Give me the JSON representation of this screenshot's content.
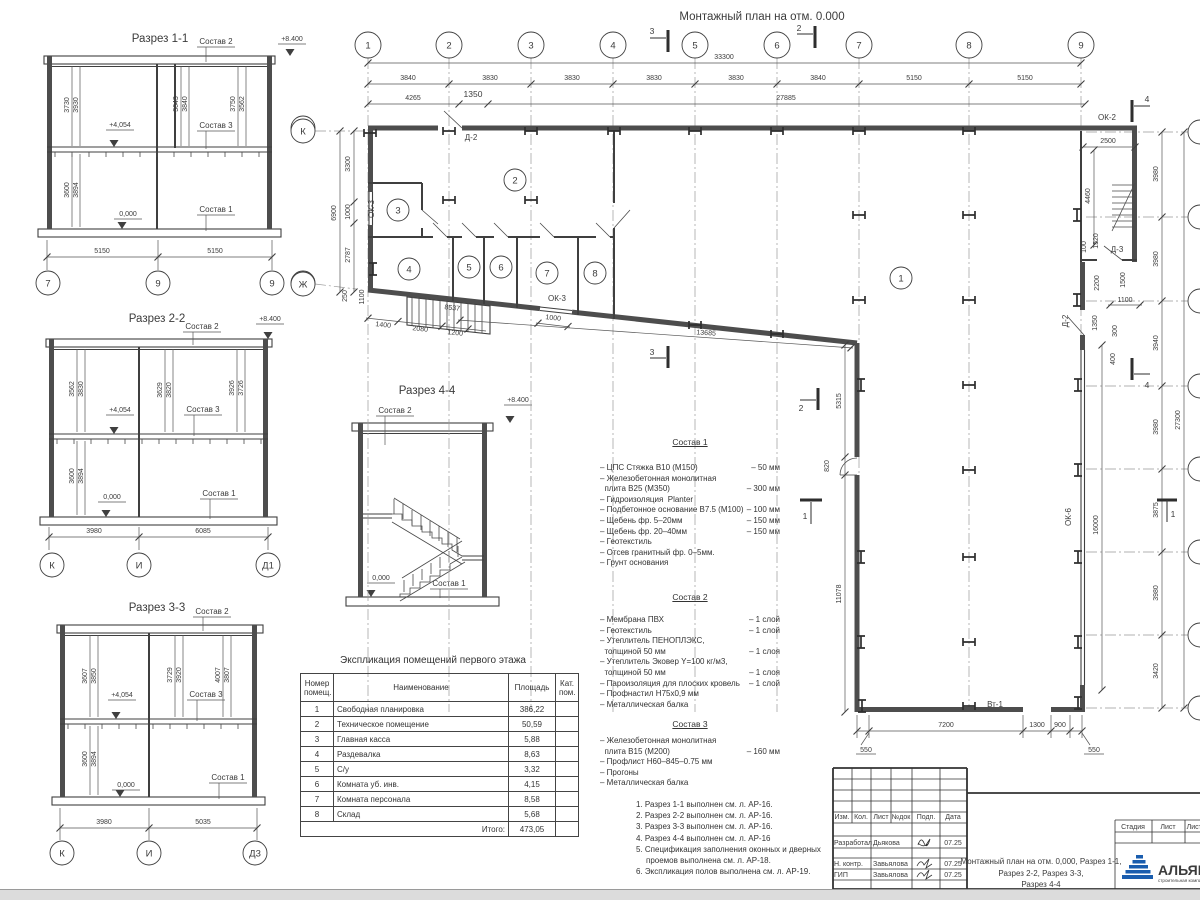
{
  "plan": {
    "title": "Монтажный план на отм. 0.000",
    "grid_cols": [
      "1",
      "2",
      "3",
      "4",
      "5",
      "6",
      "7",
      "8",
      "9"
    ],
    "grid_rows": [
      "К",
      "Ж"
    ],
    "dim_rows": {
      "total": "33300",
      "cols": [
        "3840",
        "3830",
        "3830",
        "3830",
        "3830",
        "3840",
        "5150",
        "5150"
      ],
      "row2": [
        "4265",
        "1350",
        "27885"
      ]
    },
    "dims_left": [
      "3300",
      "1000",
      "2787",
      "6900",
      "250",
      "1100"
    ],
    "dims_right": [
      "3980",
      "3980",
      "3940",
      "3980",
      "3875",
      "3980",
      "3420"
    ],
    "right_total": "27300",
    "dims_bottom": [
      "550",
      "7200",
      "1300",
      "900",
      "550"
    ],
    "dims_wall_right": [
      "5315",
      "820",
      "11078",
      "16000"
    ],
    "dims_tower": [
      "2500",
      "4460",
      "100",
      "1520",
      "2200",
      "1500",
      "1100",
      "1350",
      "300",
      "400"
    ],
    "dims_slope": [
      "1400",
      "2080",
      "1200",
      "8537",
      "1000",
      "13685"
    ],
    "rooms": [
      "1",
      "2",
      "3",
      "4",
      "5",
      "6",
      "7",
      "8"
    ],
    "labels": {
      "ok2": "ОК-2",
      "ok3_left": "ОК-3",
      "ok3_bottom": "ОК-3",
      "ok6": "ОК-6",
      "d2_top": "Д-2",
      "d2_right": "Д-2",
      "d3": "Д-3",
      "vt1": "Вт-1"
    },
    "marks": {
      "m1": "1",
      "m2": "2",
      "m3": "3",
      "m4": "4"
    }
  },
  "sections": {
    "s11": {
      "title": "Разрез 1-1",
      "elev_top": "+8.400",
      "elev_mid": "+4,054",
      "elev_zero": "0,000",
      "lbl1": "Состав 1",
      "lbl2": "Состав 2",
      "lbl3": "Состав 3",
      "dims_upper": [
        "3730",
        "3930",
        "3643",
        "3840",
        "3750",
        "3562"
      ],
      "dims_lower": [
        "3600",
        "3894"
      ],
      "dims_bottom": [
        "5150",
        "5150"
      ],
      "grid": [
        "7",
        "9",
        "9"
      ],
      "grid_right": [
        "К",
        "Ж"
      ]
    },
    "s22": {
      "title": "Разрез 2-2",
      "elev_top": "+8.400",
      "elev_mid": "+4,054",
      "elev_zero": "0,000",
      "lbl1": "Состав 1",
      "lbl2": "Состав 2",
      "lbl3": "Состав 3",
      "dims_upper": [
        "3562",
        "3830",
        "3629",
        "3820",
        "3926",
        "3726"
      ],
      "dims_lower": [
        "3600",
        "3894"
      ],
      "dims_bottom": [
        "3980",
        "6085"
      ],
      "grid": [
        "К",
        "И",
        "Д1"
      ]
    },
    "s33": {
      "title": "Разрез 3-3",
      "elev_mid": "+4,054",
      "elev_zero": "0,000",
      "lbl1": "Состав 1",
      "lbl2": "Состав 2",
      "lbl3": "Состав 3",
      "dims_upper": [
        "3607",
        "3850",
        "3729",
        "3920",
        "4007",
        "3807"
      ],
      "dims_lower": [
        "3600",
        "3894"
      ],
      "dims_bottom": [
        "3980",
        "5035"
      ],
      "grid": [
        "К",
        "И",
        "Д3"
      ]
    },
    "s44": {
      "title": "Разрез 4-4",
      "elev_top": "+8.400",
      "elev_zero": "0,000",
      "lbl1": "Состав 1",
      "lbl2": "Состав 2"
    }
  },
  "table": {
    "title": "Экспликация помещений первого этажа",
    "headers": [
      "Номер помещ.",
      "Наименование",
      "Площадь",
      "Кат. пом."
    ],
    "rows": [
      [
        "1",
        "Свободная планировка",
        "386,22"
      ],
      [
        "2",
        "Техническое помещение",
        "50,59"
      ],
      [
        "3",
        "Главная касса",
        "5,88"
      ],
      [
        "4",
        "Раздевалка",
        "8,63"
      ],
      [
        "5",
        "С/у",
        "3,32"
      ],
      [
        "6",
        "Комната уб. инв.",
        "4,15"
      ],
      [
        "7",
        "Комната персонала",
        "8,58"
      ],
      [
        "8",
        "Склад",
        "5,68"
      ]
    ],
    "total_label": "Итого:",
    "total_value": "473,05"
  },
  "sostav1": {
    "title": "Состав 1",
    "lines": [
      {
        "t": "– ЦПС Стяжка В10 (М150)",
        "v": "– 50 мм"
      },
      {
        "t": "– Железобетонная монолитная",
        "v": ""
      },
      {
        "t": "  плита В25 (М350)",
        "v": "– 300 мм"
      },
      {
        "t": "– Гидроизоляция  Planter",
        "v": ""
      },
      {
        "t": "– Подбетонное основание В7.5 (М100)",
        "v": "– 100 мм"
      },
      {
        "t": "– Щебень фр. 5–20мм",
        "v": "– 150 мм"
      },
      {
        "t": "– Щебень фр. 20–40мм",
        "v": "– 150 мм"
      },
      {
        "t": "– Геотекстиль",
        "v": ""
      },
      {
        "t": "– Отсев гранитный фр. 0–5мм.",
        "v": ""
      },
      {
        "t": "– Грунт основания",
        "v": ""
      }
    ]
  },
  "sostav2": {
    "title": "Состав 2",
    "lines": [
      {
        "t": "– Мембрана ПВХ",
        "v": "– 1 слой"
      },
      {
        "t": "– Геотекстиль",
        "v": "– 1 слой"
      },
      {
        "t": "– Утеплитель ПЕНОПЛЭКС,",
        "v": ""
      },
      {
        "t": "  толщиной 50 мм",
        "v": "– 1 слоя"
      },
      {
        "t": "– Утеплитель Эковер Y=100 кг/м3,",
        "v": ""
      },
      {
        "t": "  толщиной 50 мм",
        "v": "– 1 слоя"
      },
      {
        "t": "– Пароизоляция для плоских кровель",
        "v": "– 1 слой"
      },
      {
        "t": "– Профнастил Н75х0,9 мм",
        "v": ""
      },
      {
        "t": "– Металлическая балка",
        "v": ""
      }
    ]
  },
  "sostav3": {
    "title": "Состав 3",
    "lines": [
      {
        "t": "– Железобетонная монолитная",
        "v": ""
      },
      {
        "t": "  плита В15 (М200)",
        "v": "– 160 мм"
      },
      {
        "t": "– Профлист Н60–845–0.75 мм",
        "v": ""
      },
      {
        "t": "– Прогоны",
        "v": ""
      },
      {
        "t": "– Металлическая балка",
        "v": ""
      }
    ]
  },
  "notes": [
    "1. Разрез 1-1 выполнен см. л. АР-16.",
    "2. Разрез 2-2 выполнен см. л. АР-16.",
    "3. Разрез 3-3 выполнен см. л. АР-16.",
    "4. Разрез 4-4 выполнен см. л. АР-16",
    "5. Спецификация заполнения оконных и дверных проемов выполнена см. л. АР-18.",
    "6. Экспликация полов выполнена см. л. АР-19."
  ],
  "titleblock": {
    "cols": [
      "Изм.",
      "Кол.",
      "Лист",
      "№док",
      "Подп.",
      "Дата"
    ],
    "rows": [
      {
        "role": "Разработал",
        "name": "Дьякова",
        "date": "07.25"
      },
      {
        "role": "Н. контр.",
        "name": "Завьялова",
        "date": "07.25"
      },
      {
        "role": "ГИП",
        "name": "Завьялова",
        "date": "07.25"
      }
    ],
    "doc_title_lines": [
      "Монтажный план на отм. 0,000, Разрез 1-1,",
      "Разрез 2-2, Разрез 3-3,",
      "Разрез 4-4"
    ],
    "right_cols": [
      "Стадия",
      "Лист",
      "Листов"
    ]
  },
  "logo": {
    "name": "АЛЬЯНС",
    "tagline": "строительная компания",
    "color": "#1a5dae",
    "tag_color": "#cc3344"
  }
}
